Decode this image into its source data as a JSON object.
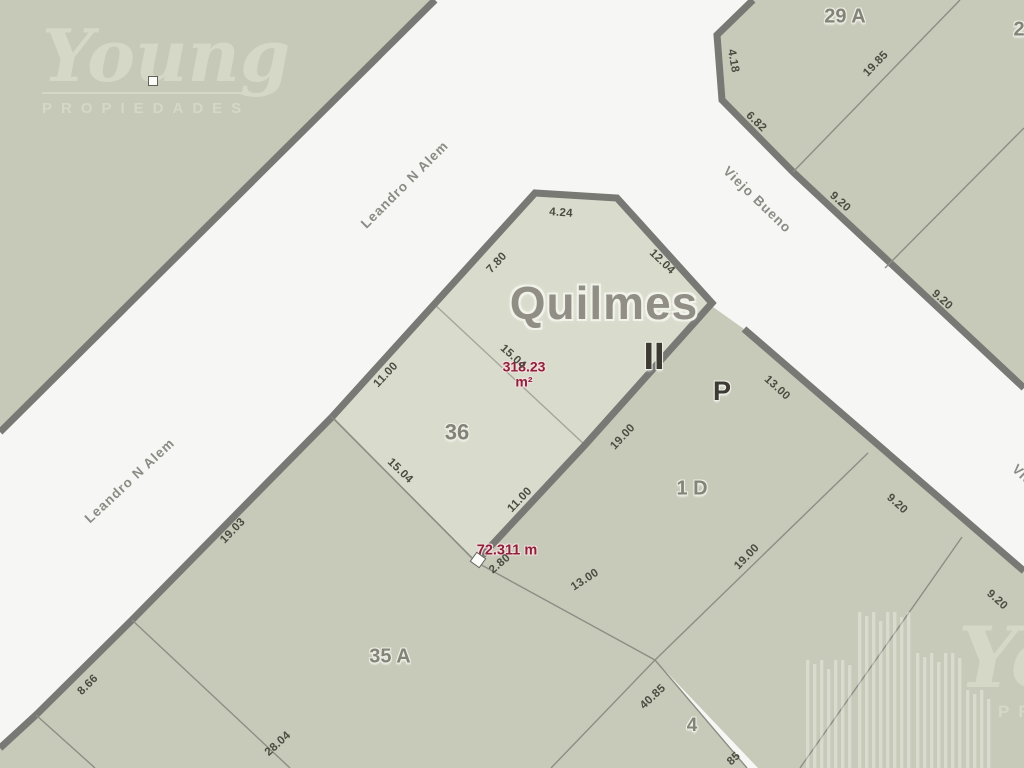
{
  "watermark": {
    "brand": "Young",
    "subtitle": "PROPIEDADES"
  },
  "map": {
    "city_label": "Quilmes",
    "section_label": "II",
    "area_label": "318.23\nm²",
    "distance_label": "72.311 m",
    "colors": {
      "street": "#f6f6f4",
      "parcel": "#c7cab8",
      "highlight_parcel": "#d9dbcc",
      "street_border": "#787875",
      "boundary_line": "#8d8d85",
      "measure_text": "#4b4b42",
      "red_text": "#8e2136"
    },
    "street_labels": [
      {
        "name": "Leandro N Alem",
        "x": 405,
        "y": 185,
        "rot": -45
      },
      {
        "name": "Leandro N Alem",
        "x": 130,
        "y": 481,
        "rot": -43
      },
      {
        "name": "Viejo Bueno",
        "x": 757,
        "y": 200,
        "rot": 44
      },
      {
        "name": "Viejo Bueno",
        "x": 1046,
        "y": 498,
        "rot": 44
      }
    ],
    "parcel_labels": [
      {
        "text": "29 A",
        "x": 845,
        "y": 17,
        "size": 20,
        "dark": false
      },
      {
        "text": "2",
        "x": 1019,
        "y": 30,
        "size": 20,
        "dark": false
      },
      {
        "text": "P",
        "x": 722,
        "y": 391,
        "size": 27,
        "dark": true
      },
      {
        "text": "1 D",
        "x": 692,
        "y": 489,
        "size": 20,
        "dark": false
      },
      {
        "text": "36",
        "x": 457,
        "y": 432,
        "size": 22,
        "dark": false
      },
      {
        "text": "35 A",
        "x": 390,
        "y": 657,
        "size": 20,
        "dark": false
      },
      {
        "text": "4",
        "x": 692,
        "y": 726,
        "size": 19,
        "dark": false
      },
      {
        "text": "II",
        "x": 654,
        "y": 358,
        "size": 38,
        "dark": true
      }
    ],
    "measurements": [
      {
        "text": "4.24",
        "x": 561,
        "y": 213,
        "rot": 4
      },
      {
        "text": "12.04",
        "x": 662,
        "y": 262,
        "rot": 44
      },
      {
        "text": "7.80",
        "x": 497,
        "y": 263,
        "rot": -47
      },
      {
        "text": "15.04",
        "x": 513,
        "y": 357,
        "rot": 42
      },
      {
        "text": "11.00",
        "x": 386,
        "y": 375,
        "rot": -47
      },
      {
        "text": "15.04",
        "x": 400,
        "y": 471,
        "rot": 44
      },
      {
        "text": "11.00",
        "x": 520,
        "y": 500,
        "rot": -46
      },
      {
        "text": "19.00",
        "x": 623,
        "y": 437,
        "rot": -47
      },
      {
        "text": "19.03",
        "x": 233,
        "y": 531,
        "rot": -46
      },
      {
        "text": "8.66",
        "x": 88,
        "y": 685,
        "rot": -45
      },
      {
        "text": "28.04",
        "x": 278,
        "y": 744,
        "rot": -42
      },
      {
        "text": "2.80",
        "x": 500,
        "y": 564,
        "rot": -40
      },
      {
        "text": "13.00",
        "x": 585,
        "y": 580,
        "rot": -33
      },
      {
        "text": "40.85",
        "x": 653,
        "y": 697,
        "rot": -43
      },
      {
        "text": "85",
        "x": 734,
        "y": 759,
        "rot": -43
      },
      {
        "text": "19.00",
        "x": 747,
        "y": 557,
        "rot": -46
      },
      {
        "text": "13.00",
        "x": 777,
        "y": 388,
        "rot": 42
      },
      {
        "text": "9.20",
        "x": 897,
        "y": 504,
        "rot": 42
      },
      {
        "text": "9.20",
        "x": 997,
        "y": 600,
        "rot": 42
      },
      {
        "text": "4.18",
        "x": 733,
        "y": 61,
        "rot": 80
      },
      {
        "text": "6.82",
        "x": 756,
        "y": 122,
        "rot": 44
      },
      {
        "text": "19.85",
        "x": 876,
        "y": 64,
        "rot": -46
      },
      {
        "text": "9.20",
        "x": 840,
        "y": 202,
        "rot": 42
      },
      {
        "text": "9.20",
        "x": 942,
        "y": 300,
        "rot": 42
      }
    ]
  }
}
